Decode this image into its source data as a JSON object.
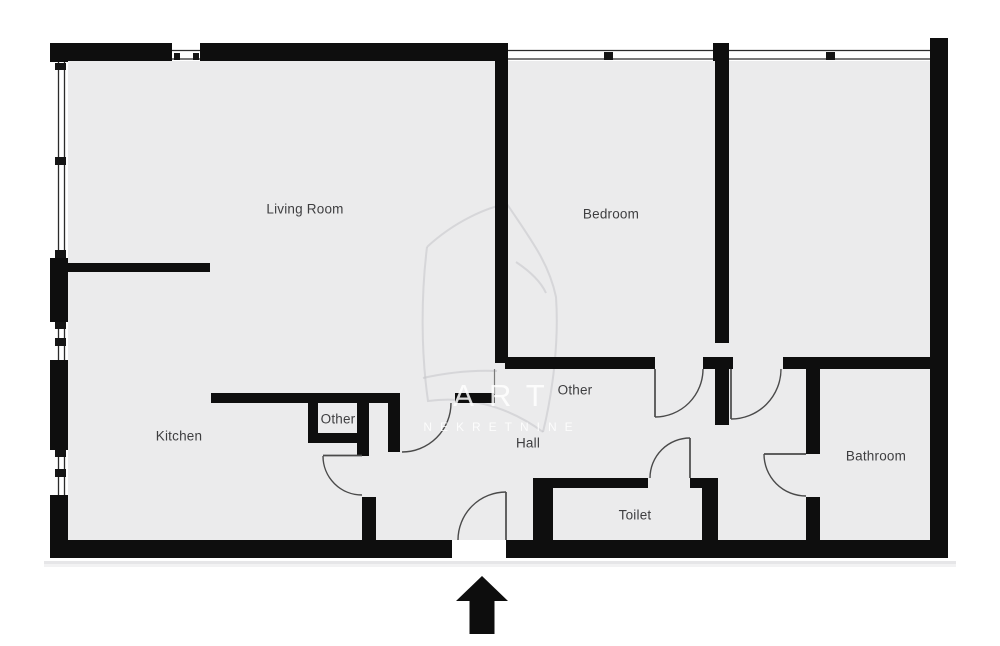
{
  "figure": {
    "type": "floor-plan"
  },
  "rooms": [
    {
      "name": "living-room",
      "label": "Living Room"
    },
    {
      "name": "bedroom",
      "label": "Bedroom"
    },
    {
      "name": "kitchen",
      "label": "Kitchen"
    },
    {
      "name": "closet",
      "label": "Other"
    },
    {
      "name": "hall-upper",
      "label": "Other"
    },
    {
      "name": "hall",
      "label": "Hall"
    },
    {
      "name": "toilet",
      "label": "Toilet"
    },
    {
      "name": "bathroom",
      "label": "Bathroom"
    }
  ],
  "watermark": {
    "line1": "ART",
    "line2": "NEKRETNINE"
  },
  "colors": {
    "wall": "#0e0e0e",
    "floor": "#ebebec",
    "background": "#ffffff",
    "label_text": "#3e3e40",
    "door_line": "#4a4a4a",
    "watermark_text": "#ffffff"
  },
  "symbols": {
    "entrance_arrow_direction": "up"
  }
}
